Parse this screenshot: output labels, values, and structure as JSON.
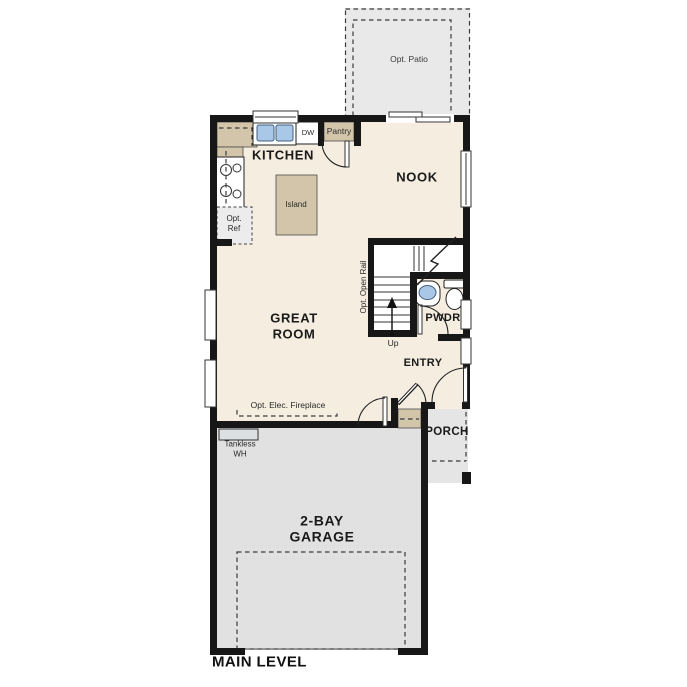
{
  "plan": {
    "title": "MAIN LEVEL",
    "rooms": {
      "kitchen": "KITCHEN",
      "nook": "NOOK",
      "great_room_line1": "GREAT",
      "great_room_line2": "ROOM",
      "powder": "PWDR",
      "entry": "ENTRY",
      "porch": "PORCH",
      "garage_line1": "2-BAY",
      "garage_line2": "GARAGE",
      "patio": "Opt. Patio"
    },
    "features": {
      "pantry": "Pantry",
      "dishwasher": "DW",
      "island": "Island",
      "opt_ref_line1": "Opt.",
      "opt_ref_line2": "Ref",
      "opt_open_rail": "Opt. Open Rail",
      "stairs_up": "Up",
      "fireplace": "Opt. Elec. Fireplace",
      "tankless_line1": "Tankless",
      "tankless_line2": "WH"
    },
    "colors": {
      "wall": "#171717",
      "floor": "#f4ede0",
      "cabinet": "#d3c5a9",
      "garage_floor": "#e1e1e1",
      "porch_floor": "#e5e5e5",
      "patio_floor": "#e9e9e9",
      "sink_blue": "#a9c7e6"
    }
  }
}
